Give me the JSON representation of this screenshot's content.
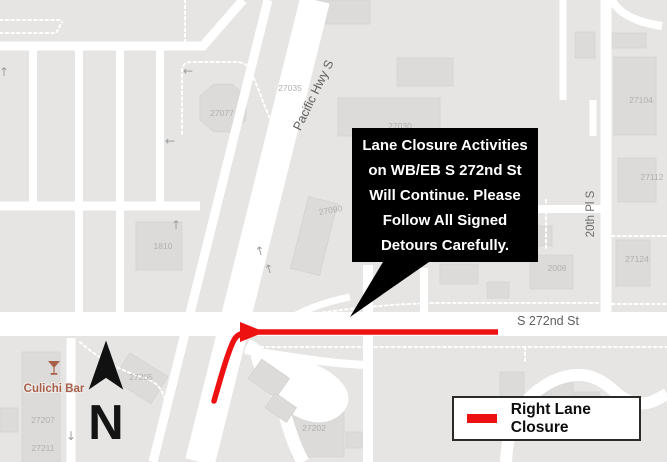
{
  "glyphs": {
    "up": "↑",
    "down": "↓",
    "left": "←"
  },
  "map": {
    "streets": [
      {
        "name": "Pacific Hwy S"
      },
      {
        "name": "S 272nd St"
      },
      {
        "name": "20th Pl S"
      }
    ],
    "building_numbers": [
      "27077",
      "27035",
      "27030",
      "27090",
      "1810",
      "27104",
      "27112",
      "27124",
      "2006",
      "27202",
      "27205",
      "27207",
      "27211"
    ],
    "poi": {
      "name": "Culichi Bar"
    }
  },
  "callout": {
    "lines": [
      "Lane Closure Activities",
      "on WB/EB S 272nd St",
      "Will Continue. Please",
      "Follow All Signed",
      "Detours Carefully."
    ]
  },
  "legend": {
    "label": "Right Lane Closure"
  },
  "compass": {
    "label": "N"
  },
  "colors": {
    "closure_red": "#ee1111",
    "callout_bg": "#000000",
    "poi_text": "#a9604a",
    "map_bg": "#e6e5e3",
    "road": "#ffffff",
    "building": "#dcdbd9"
  }
}
